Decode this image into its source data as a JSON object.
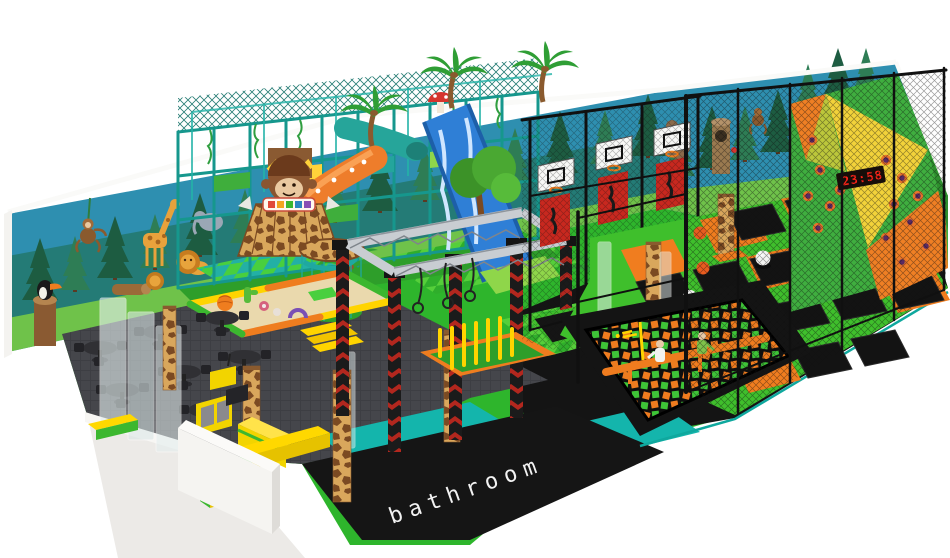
{
  "scene": {
    "type": "3d-render-indoor-playground",
    "theme": "jungle-safari",
    "background": "#ffffff",
    "labels": {
      "bathroom_floor": "bathroom",
      "climbing_wall_timer": "23:58"
    },
    "areas": [
      {
        "name": "jungle-mural-walls",
        "color": "#2e8fb0"
      },
      {
        "name": "soft-play-jungle-gym",
        "color": "#16978d"
      },
      {
        "name": "toddler-soft-play-pen",
        "color": "#ead9ad"
      },
      {
        "name": "monkey-hut-tower",
        "color": "#d9a75c"
      },
      {
        "name": "ninja-truss-course",
        "color": "#c9cdd2"
      },
      {
        "name": "yellow-pole-obstacle",
        "color": "#ffd400"
      },
      {
        "name": "basketball-dunk-lanes",
        "color": "#c8281f"
      },
      {
        "name": "trampoline-grid",
        "color": "#3fbf2c"
      },
      {
        "name": "foam-ball-pit",
        "color": "#ef7c1f"
      },
      {
        "name": "climbing-wall",
        "color": "#f2d23a"
      },
      {
        "name": "cafe-seating-area",
        "color": "#45464b"
      },
      {
        "name": "reception-counter",
        "color": "#f2d400"
      },
      {
        "name": "bathroom-area",
        "color": "#151515"
      }
    ],
    "palette": {
      "floor_green": "#3fbf2c",
      "walkway_teal": "#14b5ac",
      "pad_orange": "#f07d1f",
      "carpet_gray": "#45464b",
      "platform_black": "#141414",
      "giraffe_tan": "#d9a75c",
      "giraffe_brown": "#7b4a22",
      "mural_sky": "#2e8fb0",
      "pine_dark": "#1d5c41",
      "pine_mid": "#2e7d55",
      "slide_blue": "#2f7fd6",
      "slide_orange": "#ee7d2b",
      "bench_yellow": "#ffd800",
      "timer_red": "#ff2418"
    }
  }
}
